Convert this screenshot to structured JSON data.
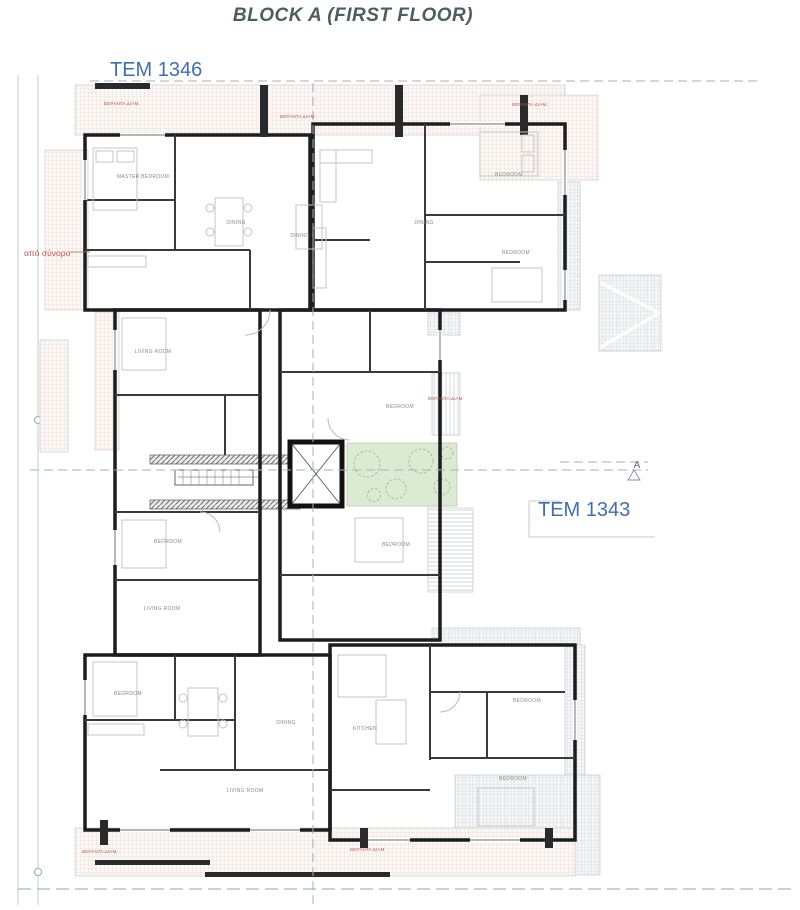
{
  "title": "BLOCK A (FIRST FLOOR)",
  "parcels": {
    "left": "TEM 1346",
    "right": "TEM 1343"
  },
  "annotations": {
    "boundary_note": "από σύνορο",
    "section_marker": "A"
  },
  "colors": {
    "title": "#4d5e63",
    "parcel_label": "#3f70ae",
    "boundary_note": "#c2544d",
    "wall": "#1d1d1d",
    "terrace_hatch": "#e2d2cb",
    "garden_fill": "#dcead3"
  },
  "room_labels": [
    {
      "text": "MASTER BEDROOM",
      "x": 143,
      "y": 178
    },
    {
      "text": "DINING",
      "x": 236,
      "y": 224
    },
    {
      "text": "DINING",
      "x": 300,
      "y": 237
    },
    {
      "text": "BEDROOM",
      "x": 509,
      "y": 176
    },
    {
      "text": "BEDROOM",
      "x": 516,
      "y": 254
    },
    {
      "text": "DINING",
      "x": 424,
      "y": 224
    },
    {
      "text": "LIVING ROOM",
      "x": 153,
      "y": 353
    },
    {
      "text": "BEDROOM",
      "x": 400,
      "y": 408
    },
    {
      "text": "BEDROOM",
      "x": 168,
      "y": 543
    },
    {
      "text": "LIVING ROOM",
      "x": 162,
      "y": 610
    },
    {
      "text": "BEDROOM",
      "x": 396,
      "y": 546
    },
    {
      "text": "BEDROOM",
      "x": 128,
      "y": 695
    },
    {
      "text": "DINING",
      "x": 286,
      "y": 724
    },
    {
      "text": "LIVING ROOM",
      "x": 245,
      "y": 792
    },
    {
      "text": "BEDROOM",
      "x": 527,
      "y": 702
    },
    {
      "text": "KITCHEN",
      "x": 365,
      "y": 730
    },
    {
      "text": "BEDROOM",
      "x": 513,
      "y": 780
    }
  ],
  "veranda_labels": [
    {
      "text": "ΒΕΡΑΝΤΑ ΔΙΑΜ.",
      "x": 122,
      "y": 105
    },
    {
      "text": "ΒΕΡΑΝΤΑ ΔΙΑΜ.",
      "x": 298,
      "y": 118
    },
    {
      "text": "ΒΕΡΑΝΤΑ ΔΙΑΜ.",
      "x": 530,
      "y": 106
    },
    {
      "text": "ΒΕΡΑΝΤΑ ΔΙΑΜ.",
      "x": 100,
      "y": 853
    },
    {
      "text": "ΒΕΡΑΝΤΑ ΔΙΑΜ.",
      "x": 368,
      "y": 851
    },
    {
      "text": "ΒΕΡΑΝΤΑ ΔΙΑΜ.",
      "x": 446,
      "y": 400
    }
  ]
}
